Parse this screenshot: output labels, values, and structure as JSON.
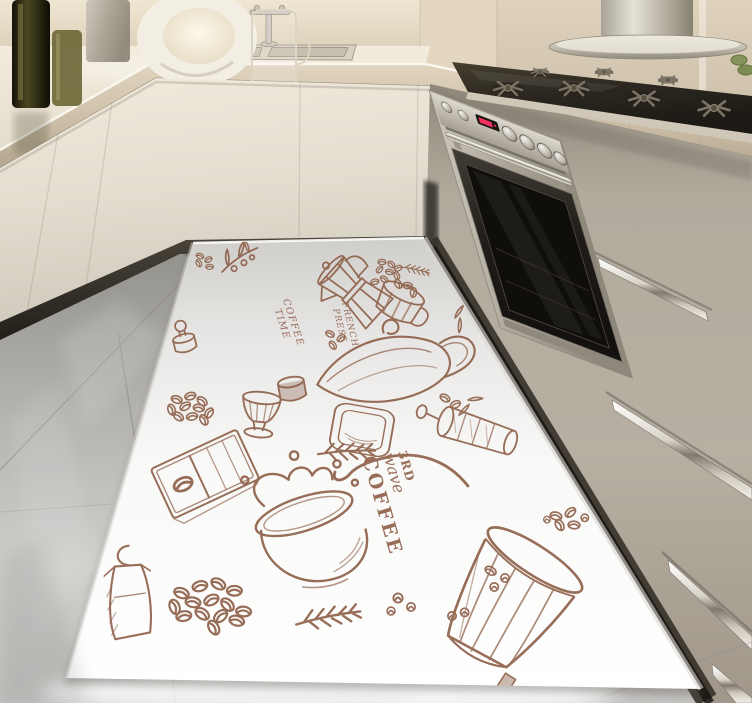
{
  "scene": {
    "objects": [
      "back-wall",
      "range-hood",
      "gas-cooktop",
      "built-in-oven",
      "kitchen-sink",
      "sink-faucet",
      "oil-bottles",
      "ring-lamp",
      "glass-mug",
      "cream-cabinets",
      "drawer-handles",
      "tile-floor",
      "coffee-doodle-floor-mat"
    ]
  },
  "rug": {
    "texts": {
      "badge_line1": "3RD",
      "badge_line2": "wave",
      "badge_line3": "COFFEE",
      "script_left_1": "COFFEE",
      "script_left_2": "TIME",
      "script_right_1": "FRENCH",
      "script_right_2": "PRESS"
    },
    "ink_color": "#8a5a42",
    "base_color": "#ffffff",
    "motifs": [
      "coffee-branch",
      "coffee-beans",
      "moka-pot",
      "mug-of-beans",
      "glass-kettle",
      "dessert-glass",
      "tamper",
      "square-plate",
      "french-press",
      "chocolate-bar",
      "splashing-coffee-cup",
      "ribbed-paper-cup",
      "steam-swirl",
      "apron",
      "bean-pile",
      "sprigs",
      "leaves"
    ]
  },
  "palette": {
    "mat_ink": "#8a5a42",
    "mat_white": "#ffffff",
    "wall_beige": "#e7dcc5",
    "cabinet_cream": "#e6e0d3",
    "drawer_taupe": "#b2aa9d",
    "steel": "#c6c1b5",
    "oven_glass": "#1a1713",
    "cooktop_black": "#2e2a22",
    "floor_gray": "#bfbebc",
    "toe_kick": "#2c2823",
    "display_red": "#ff3366",
    "bottle_green": "#3e3c1a",
    "plant_green": "#85935c"
  }
}
